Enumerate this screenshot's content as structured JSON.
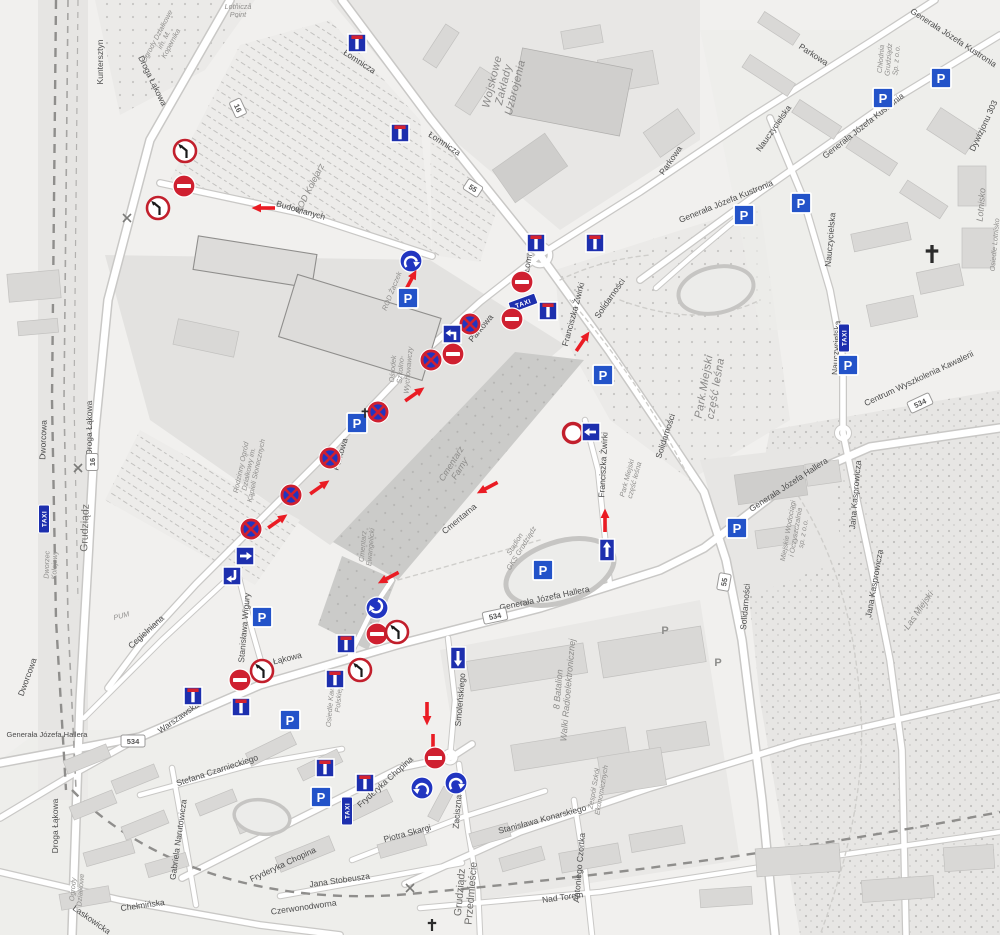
{
  "map_kind": "street-map-with-traffic-sign-overlay",
  "colors": {
    "sign_blue": "#1d2fae",
    "circle_blue": "#2135c0",
    "parking_blue": "#2353c9",
    "sign_red": "#cf2030",
    "arrow_red": "#ea1c24",
    "road_fill": "#ffffff",
    "road_casing": "#c9c8c6",
    "background": "#f1f0ee"
  },
  "labels": [
    {
      "t": "Droga Łąkowa",
      "x": 150,
      "y": 82,
      "r": 64,
      "c": "street"
    },
    {
      "t": "Kuntersztyn",
      "x": 103,
      "y": 62,
      "r": -90,
      "c": "street"
    },
    {
      "t": "Ogrody Działkowe\nim. M.\nKopernika",
      "x": 168,
      "y": 42,
      "r": -62,
      "c": "area-sm"
    },
    {
      "t": "Lotnicza\nPoint",
      "x": 238,
      "y": 14,
      "r": 0,
      "c": "area-sm"
    },
    {
      "t": "Łomnicza",
      "x": 358,
      "y": 64,
      "r": 33,
      "c": "street"
    },
    {
      "t": "Łomnicza",
      "x": 443,
      "y": 146,
      "r": 33,
      "c": "street"
    },
    {
      "t": "Łomnicza",
      "x": 532,
      "y": 255,
      "r": -80,
      "c": "street"
    },
    {
      "t": "ROD Kolejarz",
      "x": 312,
      "y": 190,
      "r": -63,
      "c": "area"
    },
    {
      "t": "Budowlanych",
      "x": 300,
      "y": 213,
      "r": 16,
      "c": "street"
    },
    {
      "t": "ROD Żaczek",
      "x": 394,
      "y": 292,
      "r": -68,
      "c": "area-sm"
    },
    {
      "t": "Wojskowe\nZakłady\nUzbrojenia",
      "x": 505,
      "y": 85,
      "r": -76,
      "c": "area-lg"
    },
    {
      "t": "Parkowa",
      "x": 812,
      "y": 57,
      "r": 33,
      "c": "street"
    },
    {
      "t": "Parkowa",
      "x": 673,
      "y": 162,
      "r": -55,
      "c": "street"
    },
    {
      "t": "Chłodnia\nGrudziądz\nSp. z o.o.",
      "x": 893,
      "y": 60,
      "r": -85,
      "c": "area-sm"
    },
    {
      "t": "Generała Józefa Kustronia",
      "x": 952,
      "y": 40,
      "r": 33,
      "c": "street"
    },
    {
      "t": "Generała Józefa Kustronia",
      "x": 865,
      "y": 128,
      "r": -38,
      "c": "street"
    },
    {
      "t": "Generała Józefa Kustronia",
      "x": 727,
      "y": 204,
      "r": -22,
      "c": "street"
    },
    {
      "t": "Nauczycielska",
      "x": 776,
      "y": 130,
      "r": -55,
      "c": "street"
    },
    {
      "t": "Nauczycielska",
      "x": 833,
      "y": 240,
      "r": -85,
      "c": "street"
    },
    {
      "t": "Nauczycielska",
      "x": 839,
      "y": 348,
      "r": -87,
      "c": "street"
    },
    {
      "t": "Dywizjonu 303",
      "x": 986,
      "y": 127,
      "r": -65,
      "c": "street"
    },
    {
      "t": "Lotnisko",
      "x": 984,
      "y": 205,
      "r": -85,
      "c": "area"
    },
    {
      "t": "Osiedle Lotnisko",
      "x": 997,
      "y": 245,
      "r": -85,
      "c": "area-sm"
    },
    {
      "t": "Centrum Wyszkolenia Kawalerii",
      "x": 920,
      "y": 381,
      "r": -25,
      "c": "street"
    },
    {
      "t": "Jana Kasprowicza",
      "x": 858,
      "y": 495,
      "r": -85,
      "c": "street"
    },
    {
      "t": "Jana Kasprowicza",
      "x": 877,
      "y": 584,
      "r": -80,
      "c": "street"
    },
    {
      "t": "Generała Józefa Hallera",
      "x": 790,
      "y": 487,
      "r": -33,
      "c": "street"
    },
    {
      "t": "Generała Józefa Hallera",
      "x": 545,
      "y": 601,
      "r": -12,
      "c": "street"
    },
    {
      "t": "Generała Józefa Hallera",
      "x": 47,
      "y": 737,
      "r": 0,
      "c": "street-sm"
    },
    {
      "t": "Miejskie Wodociągi\ni Oczyszczalnia\nsp. z o.o.",
      "x": 800,
      "y": 533,
      "r": -80,
      "c": "area-sm"
    },
    {
      "t": "Las Miejski",
      "x": 921,
      "y": 612,
      "r": -55,
      "c": "area"
    },
    {
      "t": "Solidarności",
      "x": 612,
      "y": 300,
      "r": -55,
      "c": "street"
    },
    {
      "t": "Solidarności",
      "x": 668,
      "y": 437,
      "r": -72,
      "c": "street"
    },
    {
      "t": "Solidarności",
      "x": 748,
      "y": 607,
      "r": -85,
      "c": "street"
    },
    {
      "t": "Park Miejski\nczęść leśna",
      "x": 712,
      "y": 388,
      "r": -80,
      "c": "area-lg"
    },
    {
      "t": "Park Miejski\nczęść leśna",
      "x": 634,
      "y": 480,
      "r": -75,
      "c": "area-sm"
    },
    {
      "t": "Franciszka Żwirki",
      "x": 576,
      "y": 315,
      "r": -75,
      "c": "street"
    },
    {
      "t": "Franciszka Żwirki",
      "x": 606,
      "y": 465,
      "r": -87,
      "c": "street"
    },
    {
      "t": "Stadion\nGKS Grudziądz",
      "x": 521,
      "y": 548,
      "r": -58,
      "c": "area-sm"
    },
    {
      "t": "Cmentarz\nFarny",
      "x": 458,
      "y": 468,
      "r": -58,
      "c": "area"
    },
    {
      "t": "Cmentarz\nEwangelicki",
      "x": 370,
      "y": 547,
      "r": -85,
      "c": "area-sm"
    },
    {
      "t": "Cmentarna",
      "x": 461,
      "y": 521,
      "r": -40,
      "c": "street"
    },
    {
      "t": "Ośrodek\nSzkolno-\nWychowawczy",
      "x": 405,
      "y": 370,
      "r": -85,
      "c": "area-sm"
    },
    {
      "t": "Rodzinny Ogród\nDziałkowy im.\nKąpieli Słonecznych",
      "x": 253,
      "y": 470,
      "r": -78,
      "c": "area-sm"
    },
    {
      "t": "PUM",
      "x": 122,
      "y": 618,
      "r": -15,
      "c": "area-sm"
    },
    {
      "t": "Stanisława Wigury",
      "x": 247,
      "y": 628,
      "r": -85,
      "c": "street"
    },
    {
      "t": "Osiedle Kawalerii\nPolskiej",
      "x": 338,
      "y": 700,
      "r": -85,
      "c": "area-sm"
    },
    {
      "t": "8 Batalion\nWalki Radioelektronicznej",
      "x": 566,
      "y": 690,
      "r": -85,
      "c": "area"
    },
    {
      "t": "Smoleńskiego",
      "x": 463,
      "y": 700,
      "r": -85,
      "c": "street"
    },
    {
      "t": "Łąkowa",
      "x": 288,
      "y": 661,
      "r": -14,
      "c": "street"
    },
    {
      "t": "Warszawska",
      "x": 180,
      "y": 720,
      "r": -35,
      "c": "street"
    },
    {
      "t": "Fryderyka Chopina",
      "x": 387,
      "y": 784,
      "r": -42,
      "c": "street"
    },
    {
      "t": "Fryderyka Chopina",
      "x": 284,
      "y": 867,
      "r": -25,
      "c": "street"
    },
    {
      "t": "Piotra Skargi",
      "x": 408,
      "y": 836,
      "r": -15,
      "c": "street"
    },
    {
      "t": "Zaciszna",
      "x": 460,
      "y": 812,
      "r": -85,
      "c": "street"
    },
    {
      "t": "Stanisława Konarskiego",
      "x": 543,
      "y": 822,
      "r": -15,
      "c": "street"
    },
    {
      "t": "Zespół Szkół\nEkonomicznych",
      "x": 601,
      "y": 790,
      "r": -80,
      "c": "area-sm"
    },
    {
      "t": "Antoniego Czortka",
      "x": 582,
      "y": 868,
      "r": -85,
      "c": "street"
    },
    {
      "t": "Nad Torem",
      "x": 563,
      "y": 900,
      "r": -8,
      "c": "street"
    },
    {
      "t": "Grudziądz\nPrzedmieście",
      "x": 468,
      "y": 893,
      "r": -85,
      "c": "station"
    },
    {
      "t": "Stefana Czarnieckiego",
      "x": 218,
      "y": 773,
      "r": -18,
      "c": "street"
    },
    {
      "t": "Gabriela Narutowicza",
      "x": 181,
      "y": 840,
      "r": -82,
      "c": "street"
    },
    {
      "t": "Chełmińska",
      "x": 143,
      "y": 908,
      "r": -8,
      "c": "street"
    },
    {
      "t": "Czerwonodworna",
      "x": 304,
      "y": 910,
      "r": -8,
      "c": "street"
    },
    {
      "t": "Jana Stobeusza",
      "x": 340,
      "y": 883,
      "r": -8,
      "c": "street"
    },
    {
      "t": "Laskowicka",
      "x": 90,
      "y": 922,
      "r": 35,
      "c": "street"
    },
    {
      "t": "Ogrody\nDziałkowe",
      "x": 80,
      "y": 890,
      "r": -85,
      "c": "area-sm"
    },
    {
      "t": "Dworcowa",
      "x": 46,
      "y": 440,
      "r": -88,
      "c": "street"
    },
    {
      "t": "Dworcowa",
      "x": 30,
      "y": 678,
      "r": -70,
      "c": "street"
    },
    {
      "t": "Grudziądz",
      "x": 88,
      "y": 528,
      "r": -88,
      "c": "station"
    },
    {
      "t": "Dworzec\nKolejowy",
      "x": 54,
      "y": 565,
      "r": -88,
      "c": "area-sm"
    },
    {
      "t": "Cegielniana",
      "x": 148,
      "y": 634,
      "r": -42,
      "c": "street"
    },
    {
      "t": "Parkowa",
      "x": 483,
      "y": 330,
      "r": -50,
      "c": "street"
    },
    {
      "t": "Parkowa",
      "x": 343,
      "y": 455,
      "r": -73,
      "c": "street"
    },
    {
      "t": "Droga Łąkowa",
      "x": 92,
      "y": 428,
      "r": -90,
      "c": "street"
    },
    {
      "t": "Droga Łąkowa",
      "x": 58,
      "y": 826,
      "r": -90,
      "c": "street"
    }
  ],
  "signs": [
    {
      "type": "no-turn",
      "x": 185,
      "y": 151
    },
    {
      "type": "no-entry",
      "x": 184,
      "y": 186
    },
    {
      "type": "no-turn",
      "x": 158,
      "y": 208
    },
    {
      "type": "red-arrow",
      "x": 263,
      "y": 208,
      "r": 180
    },
    {
      "type": "dead-end",
      "x": 357,
      "y": 43
    },
    {
      "type": "dead-end",
      "x": 400,
      "y": 133
    },
    {
      "type": "turn",
      "x": 411,
      "y": 261,
      "flip": 1
    },
    {
      "type": "red-arrow",
      "x": 411,
      "y": 280,
      "r": -62
    },
    {
      "type": "parking",
      "x": 408,
      "y": 298
    },
    {
      "type": "dead-end",
      "x": 536,
      "y": 243
    },
    {
      "type": "dead-end",
      "x": 595,
      "y": 243
    },
    {
      "type": "no-entry",
      "x": 522,
      "y": 282
    },
    {
      "type": "no-entry",
      "x": 512,
      "y": 319
    },
    {
      "type": "dead-end",
      "x": 548,
      "y": 311
    },
    {
      "type": "no-stopping",
      "x": 470,
      "y": 324
    },
    {
      "type": "arrow-bent-left",
      "x": 452,
      "y": 334
    },
    {
      "type": "no-entry",
      "x": 453,
      "y": 354
    },
    {
      "type": "no-stopping",
      "x": 431,
      "y": 360
    },
    {
      "type": "no-stopping",
      "x": 378,
      "y": 412
    },
    {
      "type": "parking",
      "x": 357,
      "y": 423
    },
    {
      "type": "cross",
      "x": 365,
      "y": 413,
      "s": 0.8
    },
    {
      "type": "red-arrow",
      "x": 415,
      "y": 394,
      "r": -35
    },
    {
      "type": "no-stopping",
      "x": 330,
      "y": 458
    },
    {
      "type": "red-arrow",
      "x": 320,
      "y": 487,
      "r": -35
    },
    {
      "type": "no-stopping",
      "x": 291,
      "y": 495
    },
    {
      "type": "red-arrow",
      "x": 278,
      "y": 521,
      "r": -35
    },
    {
      "type": "no-stopping",
      "x": 251,
      "y": 529
    },
    {
      "type": "arrow-right-sq",
      "x": 245,
      "y": 556
    },
    {
      "type": "arrow-bent-down",
      "x": 232,
      "y": 576
    },
    {
      "type": "parking",
      "x": 262,
      "y": 617
    },
    {
      "type": "red-arrow",
      "x": 583,
      "y": 341,
      "r": -56
    },
    {
      "type": "no-vehicles",
      "x": 573,
      "y": 433
    },
    {
      "type": "arrow-left-sq",
      "x": 591,
      "y": 432
    },
    {
      "type": "red-arrow",
      "x": 605,
      "y": 520,
      "r": -90
    },
    {
      "type": "one-way",
      "x": 607,
      "y": 550
    },
    {
      "type": "parking",
      "x": 603,
      "y": 375
    },
    {
      "type": "parking",
      "x": 543,
      "y": 570
    },
    {
      "type": "red-arrow",
      "x": 487,
      "y": 488,
      "r": 152
    },
    {
      "type": "red-arrow",
      "x": 388,
      "y": 578,
      "r": 152
    },
    {
      "type": "turn",
      "x": 377,
      "y": 608,
      "r": 150,
      "flip": 1
    },
    {
      "type": "no-entry",
      "x": 377,
      "y": 634
    },
    {
      "type": "no-turn",
      "x": 397,
      "y": 632
    },
    {
      "type": "dead-end",
      "x": 346,
      "y": 644
    },
    {
      "type": "no-turn",
      "x": 360,
      "y": 670
    },
    {
      "type": "dead-end",
      "x": 335,
      "y": 679
    },
    {
      "type": "arrow-down-rect",
      "x": 458,
      "y": 658
    },
    {
      "type": "no-turn",
      "x": 262,
      "y": 671
    },
    {
      "type": "no-entry",
      "x": 240,
      "y": 680
    },
    {
      "type": "dead-end",
      "x": 193,
      "y": 696
    },
    {
      "type": "dead-end",
      "x": 241,
      "y": 707
    },
    {
      "type": "parking",
      "x": 290,
      "y": 720
    },
    {
      "type": "red-arrow",
      "x": 427,
      "y": 714,
      "r": 90
    },
    {
      "type": "red-arrow",
      "x": 433,
      "y": 746,
      "r": 90
    },
    {
      "type": "no-entry",
      "x": 435,
      "y": 758
    },
    {
      "type": "dead-end",
      "x": 325,
      "y": 768
    },
    {
      "type": "dead-end",
      "x": 365,
      "y": 783
    },
    {
      "type": "parking",
      "x": 321,
      "y": 797
    },
    {
      "type": "turn",
      "x": 422,
      "y": 788,
      "flip": -1
    },
    {
      "type": "turn",
      "x": 456,
      "y": 783,
      "flip": 1
    },
    {
      "type": "parking",
      "x": 941,
      "y": 78
    },
    {
      "type": "parking",
      "x": 883,
      "y": 98
    },
    {
      "type": "parking",
      "x": 801,
      "y": 203
    },
    {
      "type": "parking",
      "x": 744,
      "y": 215
    },
    {
      "type": "parking",
      "x": 848,
      "y": 365
    },
    {
      "type": "parking",
      "x": 737,
      "y": 528
    },
    {
      "type": "cross",
      "x": 932,
      "y": 254,
      "s": 1.5
    },
    {
      "type": "cross",
      "x": 432,
      "y": 925,
      "s": 1
    },
    {
      "type": "gray-p",
      "x": 665,
      "y": 630
    },
    {
      "type": "gray-p",
      "x": 718,
      "y": 662
    },
    {
      "type": "rail-x",
      "x": 127,
      "y": 218
    },
    {
      "type": "rail-x",
      "x": 78,
      "y": 468
    },
    {
      "type": "rail-x",
      "x": 410,
      "y": 888
    }
  ],
  "badges": [
    {
      "v": "16",
      "x": 238,
      "y": 108,
      "r": 65,
      "k": "route"
    },
    {
      "v": "16",
      "x": 92,
      "y": 462,
      "r": -90,
      "k": "route"
    },
    {
      "v": "55",
      "x": 473,
      "y": 188,
      "r": 33,
      "k": "route"
    },
    {
      "v": "55",
      "x": 724,
      "y": 582,
      "r": -80,
      "k": "route"
    },
    {
      "v": "534",
      "x": 495,
      "y": 616,
      "r": -12,
      "k": "route"
    },
    {
      "v": "534",
      "x": 920,
      "y": 403,
      "r": -25,
      "k": "route"
    },
    {
      "v": "534",
      "x": 133,
      "y": 741,
      "r": 0,
      "k": "route"
    },
    {
      "v": "TAXI",
      "x": 523,
      "y": 303,
      "r": -20,
      "k": "taxi"
    },
    {
      "v": "TAXI",
      "x": 44,
      "y": 519,
      "r": -90,
      "k": "taxi"
    },
    {
      "v": "TAXI",
      "x": 347,
      "y": 811,
      "r": -90,
      "k": "taxi"
    },
    {
      "v": "TAXI",
      "x": 844,
      "y": 338,
      "r": -90,
      "k": "taxi"
    }
  ]
}
